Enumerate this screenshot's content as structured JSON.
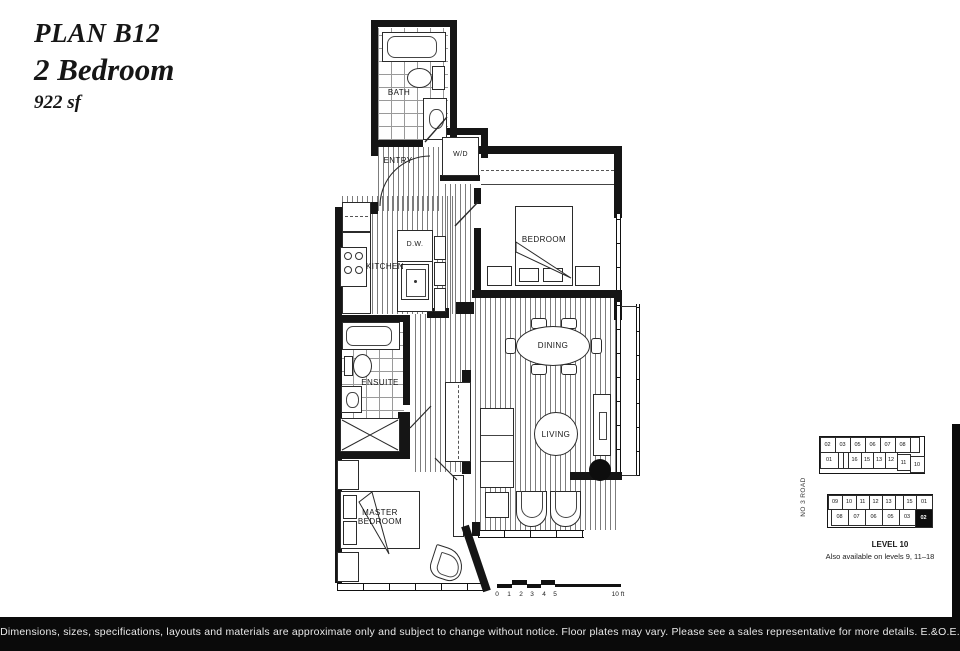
{
  "header": {
    "plan_name": "PLAN B12",
    "plan_type": "2 Bedroom",
    "plan_size": "922 sf"
  },
  "rooms": {
    "bath": "BATH",
    "entry": "ENTRY",
    "wd": "W/D",
    "kitchen": "KITCHEN",
    "dw": "D.W.",
    "bedroom": "BEDROOM",
    "dining": "DINING",
    "living": "LIVING",
    "ensuite": "ENSUITE",
    "master_bedroom": "MASTER BEDROOM"
  },
  "scale_bar": {
    "ticks": [
      "0",
      "1",
      "2",
      "3",
      "4",
      "5"
    ],
    "end_label": "10 ft"
  },
  "keyplan": {
    "road_label": "NO 3 ROAD",
    "level_label": "LEVEL 10",
    "availability_note": "Also available on levels 9, 11–18",
    "highlighted_unit": "02",
    "upper_building": {
      "top_row": [
        "02",
        "03",
        "05",
        "06",
        "07",
        "08"
      ],
      "bottom_row": [
        "01",
        "16",
        "15",
        "13",
        "12",
        "11",
        "10"
      ]
    },
    "lower_building": {
      "top_row": [
        "09",
        "10",
        "11",
        "12",
        "13",
        "15",
        "01"
      ],
      "bottom_row": [
        "08",
        "07",
        "06",
        "05",
        "03",
        "02"
      ]
    }
  },
  "footer": {
    "disclaimer": "Dimensions, sizes, specifications, layouts and materials are approximate only and subject to change without notice. Floor plates may vary. Please see a sales representative for more details. E.&O.E."
  },
  "colors": {
    "wall": "#151515",
    "footer_bg": "#0a0a0a",
    "highlight": "#0d0d0d"
  }
}
